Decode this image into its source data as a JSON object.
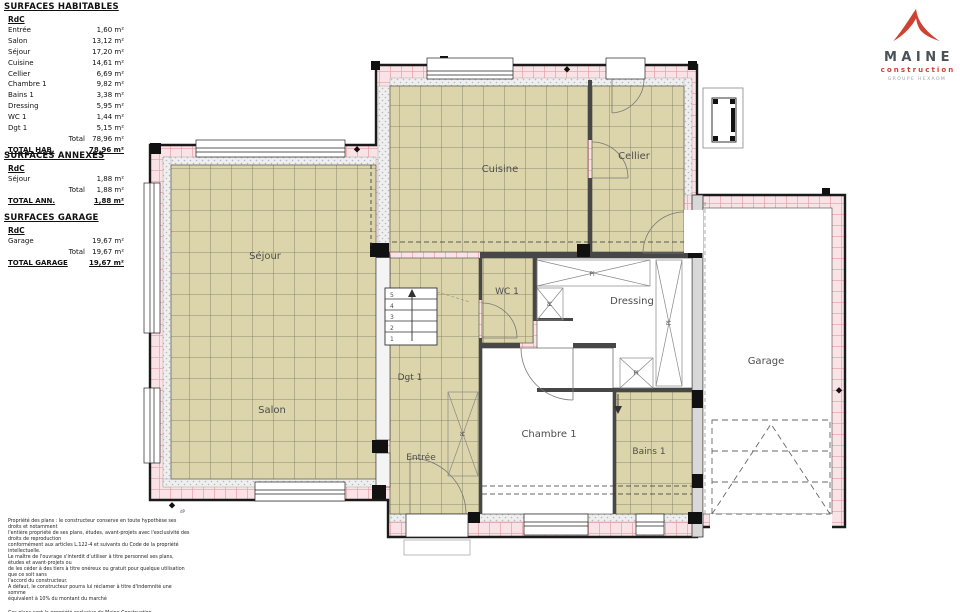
{
  "logo": {
    "brand": "MAINE",
    "sub": "construction",
    "tagline": "GROUPE HEXAOM"
  },
  "colors": {
    "tile": "#dcd5ab",
    "tile_line": "#73725c",
    "wall": "#f9e3e6",
    "wall_tick": "#eda6ae",
    "accent": "#cf4232"
  },
  "tables": {
    "habitables": {
      "title": "SURFACES HABITABLES",
      "floor": "RdC",
      "rows": [
        {
          "label": "Entrée",
          "value": "1,60 m²"
        },
        {
          "label": "Salon",
          "value": "13,12 m²"
        },
        {
          "label": "Séjour",
          "value": "17,20 m²"
        },
        {
          "label": "Cuisine",
          "value": "14,61 m²"
        },
        {
          "label": "Cellier",
          "value": "6,69 m²"
        },
        {
          "label": "Chambre 1",
          "value": "9,82 m²"
        },
        {
          "label": "Bains 1",
          "value": "3,38 m²"
        },
        {
          "label": "Dressing",
          "value": "5,95 m²"
        },
        {
          "label": "WC 1",
          "value": "1,44 m²"
        },
        {
          "label": "Dgt 1",
          "value": "5,15 m²"
        }
      ],
      "total_label": "Total",
      "total_value": "78,96 m²",
      "grand_label": "TOTAL HAB.",
      "grand_value": "78,96 m²"
    },
    "annexes": {
      "title": "SURFACES ANNEXES",
      "floor": "RdC",
      "rows": [
        {
          "label": "Séjour",
          "value": "1,88 m²"
        }
      ],
      "total_label": "Total",
      "total_value": "1,88 m²",
      "grand_label": "TOTAL ANN.",
      "grand_value": "1,88 m²"
    },
    "garage": {
      "title": "SURFACES GARAGE",
      "floor": "RdC",
      "rows": [
        {
          "label": "Garage",
          "value": "19,67 m²"
        }
      ],
      "total_label": "Total",
      "total_value": "19,67 m²",
      "grand_label": "TOTAL GARAGE",
      "grand_value": "19,67 m²"
    }
  },
  "plan": {
    "rooms": {
      "sejour": "Séjour",
      "salon": "Salon",
      "cuisine": "Cuisine",
      "cellier": "Cellier",
      "wc": "WC 1",
      "dressing": "Dressing",
      "dgt": "Dgt 1",
      "entree": "Entrée",
      "chambre": "Chambre 1",
      "bains": "Bains 1",
      "garage": "Garage"
    },
    "closet_label": "Pl",
    "stairs": [
      "5",
      "4",
      "3",
      "2",
      "1"
    ],
    "dp_mark": "dP"
  },
  "legal": {
    "lines": [
      "Propriété des plans : le constructeur conserve en toute hypothèse ses",
      "droits et notamment",
      "l'entière propriété de ses plans, études, avant-projets avec l'exclusivité des",
      "droits de reproduction",
      "conformément aux articles L.122-4 et suivants du Code de la propriété",
      "intellectuelle.",
      "Le maître de l'ouvrage s'interdit d'utiliser à titre personnel ses plans,",
      "études et avant-projets ou",
      "de les céder à des tiers à titre onéreux ou gratuit pour quelque utilisation",
      "que ce soit sans",
      "l'accord du constructeur.",
      "A défaut, le constructeur pourra lui réclamer à titre d'indemnité une",
      "somme",
      "équivalent à 10% du montant du marché"
    ],
    "footer": "Ces plans sont la propriété exclusive de Maine Construction"
  }
}
